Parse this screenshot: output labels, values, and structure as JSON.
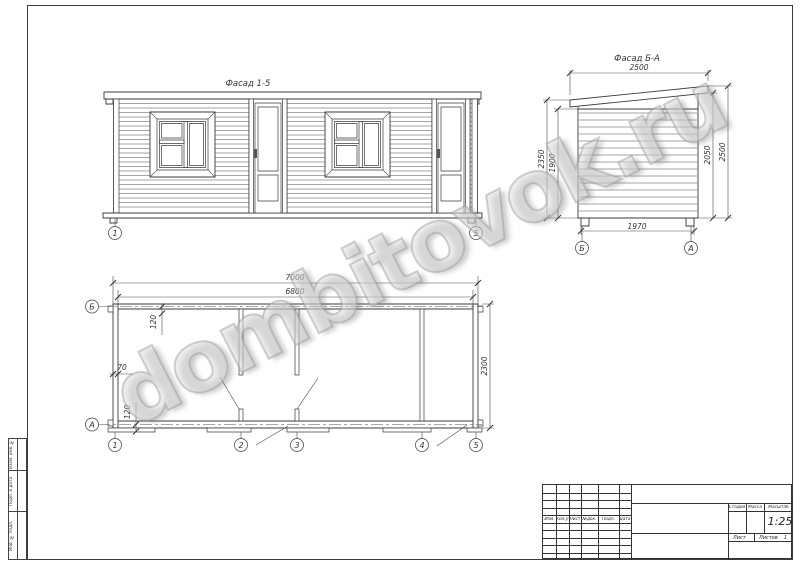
{
  "page": {
    "watermark": "dombitovok.ru"
  },
  "front_elevation": {
    "title": "Фасад 1-5",
    "axis_left": "1",
    "axis_right": "5"
  },
  "side_elevation": {
    "title": "Фасад Б-А",
    "dim_top": "2500",
    "dim_left_outer": "2350",
    "dim_left_inner": "1900",
    "dim_right_inner": "2050",
    "dim_right_outer": "2500",
    "dim_bottom": "1970",
    "axis_left": "Б",
    "axis_right": "А"
  },
  "plan": {
    "dim_overall": "7000",
    "dim_inner": "6800",
    "dim_depth": "2300",
    "dim_offset_top": "120",
    "dim_wall": "70",
    "dim_offset_bottom": "120",
    "axis_top_left": "Б",
    "axis_bottom_left": "А",
    "axes": [
      "1",
      "2",
      "3",
      "4",
      "5"
    ]
  },
  "title_block": {
    "revision_headers": [
      "Изм.",
      "Кол.уч",
      "Лист",
      "№док.",
      "Подп.",
      "Дата"
    ],
    "stage_label": "Стадия",
    "mass_label": "Масса",
    "scale_label": "Масштаб",
    "scale_value": "1:25",
    "sheet_label": "Лист",
    "sheets_label": "Листов",
    "sheets_value": "1"
  },
  "margin_stamps": [
    "Взам. инв. №",
    "Подп. и дата",
    "Инв. № подл."
  ]
}
